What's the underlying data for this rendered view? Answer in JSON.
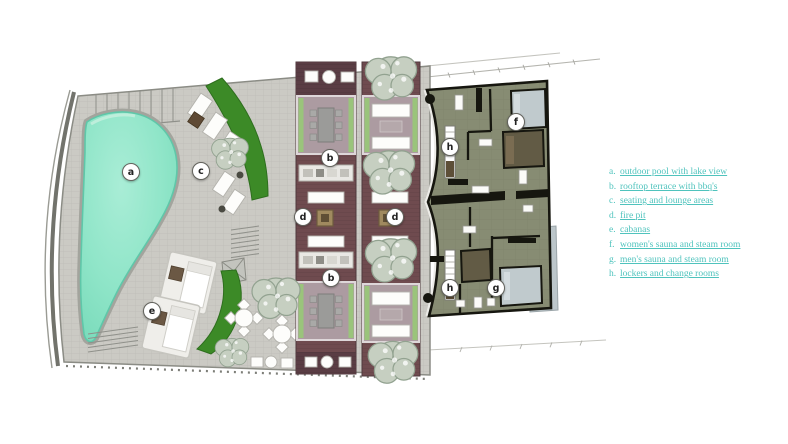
{
  "legend": {
    "items": [
      {
        "key": "a.",
        "label": "outdoor pool with lake view"
      },
      {
        "key": "b.",
        "label": "rooftop terrace with bbq's"
      },
      {
        "key": "c.",
        "label": "seating and lounge areas"
      },
      {
        "key": "d.",
        "label": "fire pit"
      },
      {
        "key": "e.",
        "label": "cabanas"
      },
      {
        "key": "f.",
        "label": "women's sauna and steam room"
      },
      {
        "key": "g.",
        "label": "men's sauna and steam room"
      },
      {
        "key": "h.",
        "label": "lockers and change rooms"
      }
    ]
  },
  "plan": {
    "markers": [
      {
        "letter": "a"
      },
      {
        "letter": "b"
      },
      {
        "letter": "b"
      },
      {
        "letter": "c"
      },
      {
        "letter": "d"
      },
      {
        "letter": "d"
      },
      {
        "letter": "e"
      },
      {
        "letter": "f"
      },
      {
        "letter": "g"
      },
      {
        "letter": "h"
      },
      {
        "letter": "h"
      }
    ],
    "colors": {
      "paving": "#cbcac4",
      "rim": "#72736c",
      "pool": "#8fe5c8",
      "pool_edge": "#5fc7a9",
      "coping": "#a3a49d",
      "hedge": "#3c8a27",
      "hedge_light": "#9ac47b",
      "deck": "#6f4b4f",
      "deck_dark": "#5a3d44",
      "pergola": "#ac9ba1",
      "tree": "#c6cfc1",
      "tree_edge": "#92a290",
      "building": "#878c73",
      "wall": "#16160f",
      "steam": "#c0cacd",
      "sauna": "#625b45",
      "legend_text": "#4fc3bd",
      "marker_bg": "#ffffff",
      "marker_text": "#222222"
    }
  }
}
